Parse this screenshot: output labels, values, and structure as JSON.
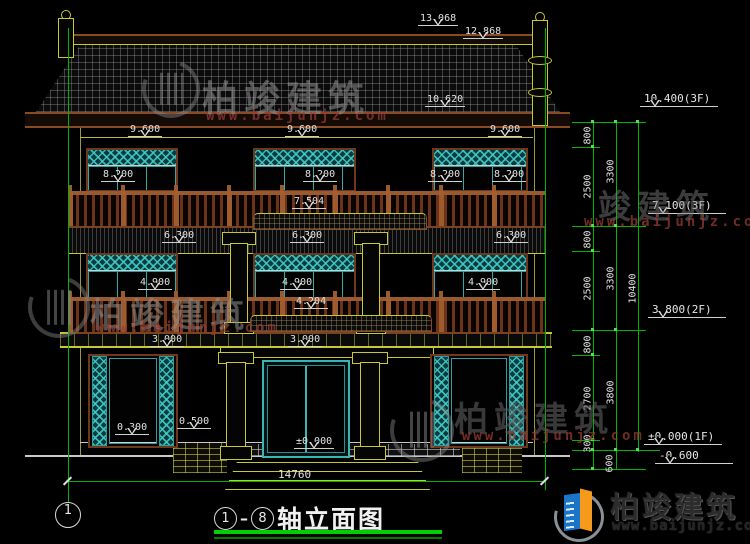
{
  "drawing": {
    "title": "①-⑧轴立面图",
    "title_name": "轴立面图",
    "axis_from": "1",
    "axis_to": "8",
    "axis_bubble_left": "1",
    "bottom_dimension": "14760"
  },
  "markers": [
    "13.068",
    "12.868",
    "10.620",
    "9.600",
    "9.600",
    "9.600",
    "8.200",
    "8.200",
    "8.200",
    "8.200",
    "7.504",
    "6.300",
    "6.300",
    "6.300",
    "4.900",
    "4.900",
    "4.900",
    "4.204",
    "3.000",
    "3.000",
    "0.300",
    "0.500",
    "±0.000"
  ],
  "right_markers": [
    "10.400(3F)",
    "7.100(3F)",
    "3.800(2F)",
    "±0.000(1F)",
    "-0.600"
  ],
  "chain": {
    "col1": [
      "800",
      "2500",
      "800",
      "2500",
      "800",
      "2700",
      "300",
      "600"
    ],
    "col2": [
      "3300",
      "3300",
      "3800"
    ],
    "col3": [
      "10400"
    ]
  },
  "watermark": {
    "brand": "柏竣建筑",
    "brand_partial": "竣建筑",
    "url": "www.baijunjz.com"
  },
  "logo": {
    "brand": "柏竣建筑",
    "url": "www.baijunjz.com"
  },
  "colors": {
    "dimension_green": "#00b400",
    "cad_yellow": "#c8c832",
    "cad_cyan": "#38b0b0",
    "railing_brown": "#8a4a28",
    "text_white": "#e2e2e2",
    "logo_blue": "#1a74c8",
    "logo_orange": "#f59a1a",
    "title_underline_green": "#00cf00"
  }
}
